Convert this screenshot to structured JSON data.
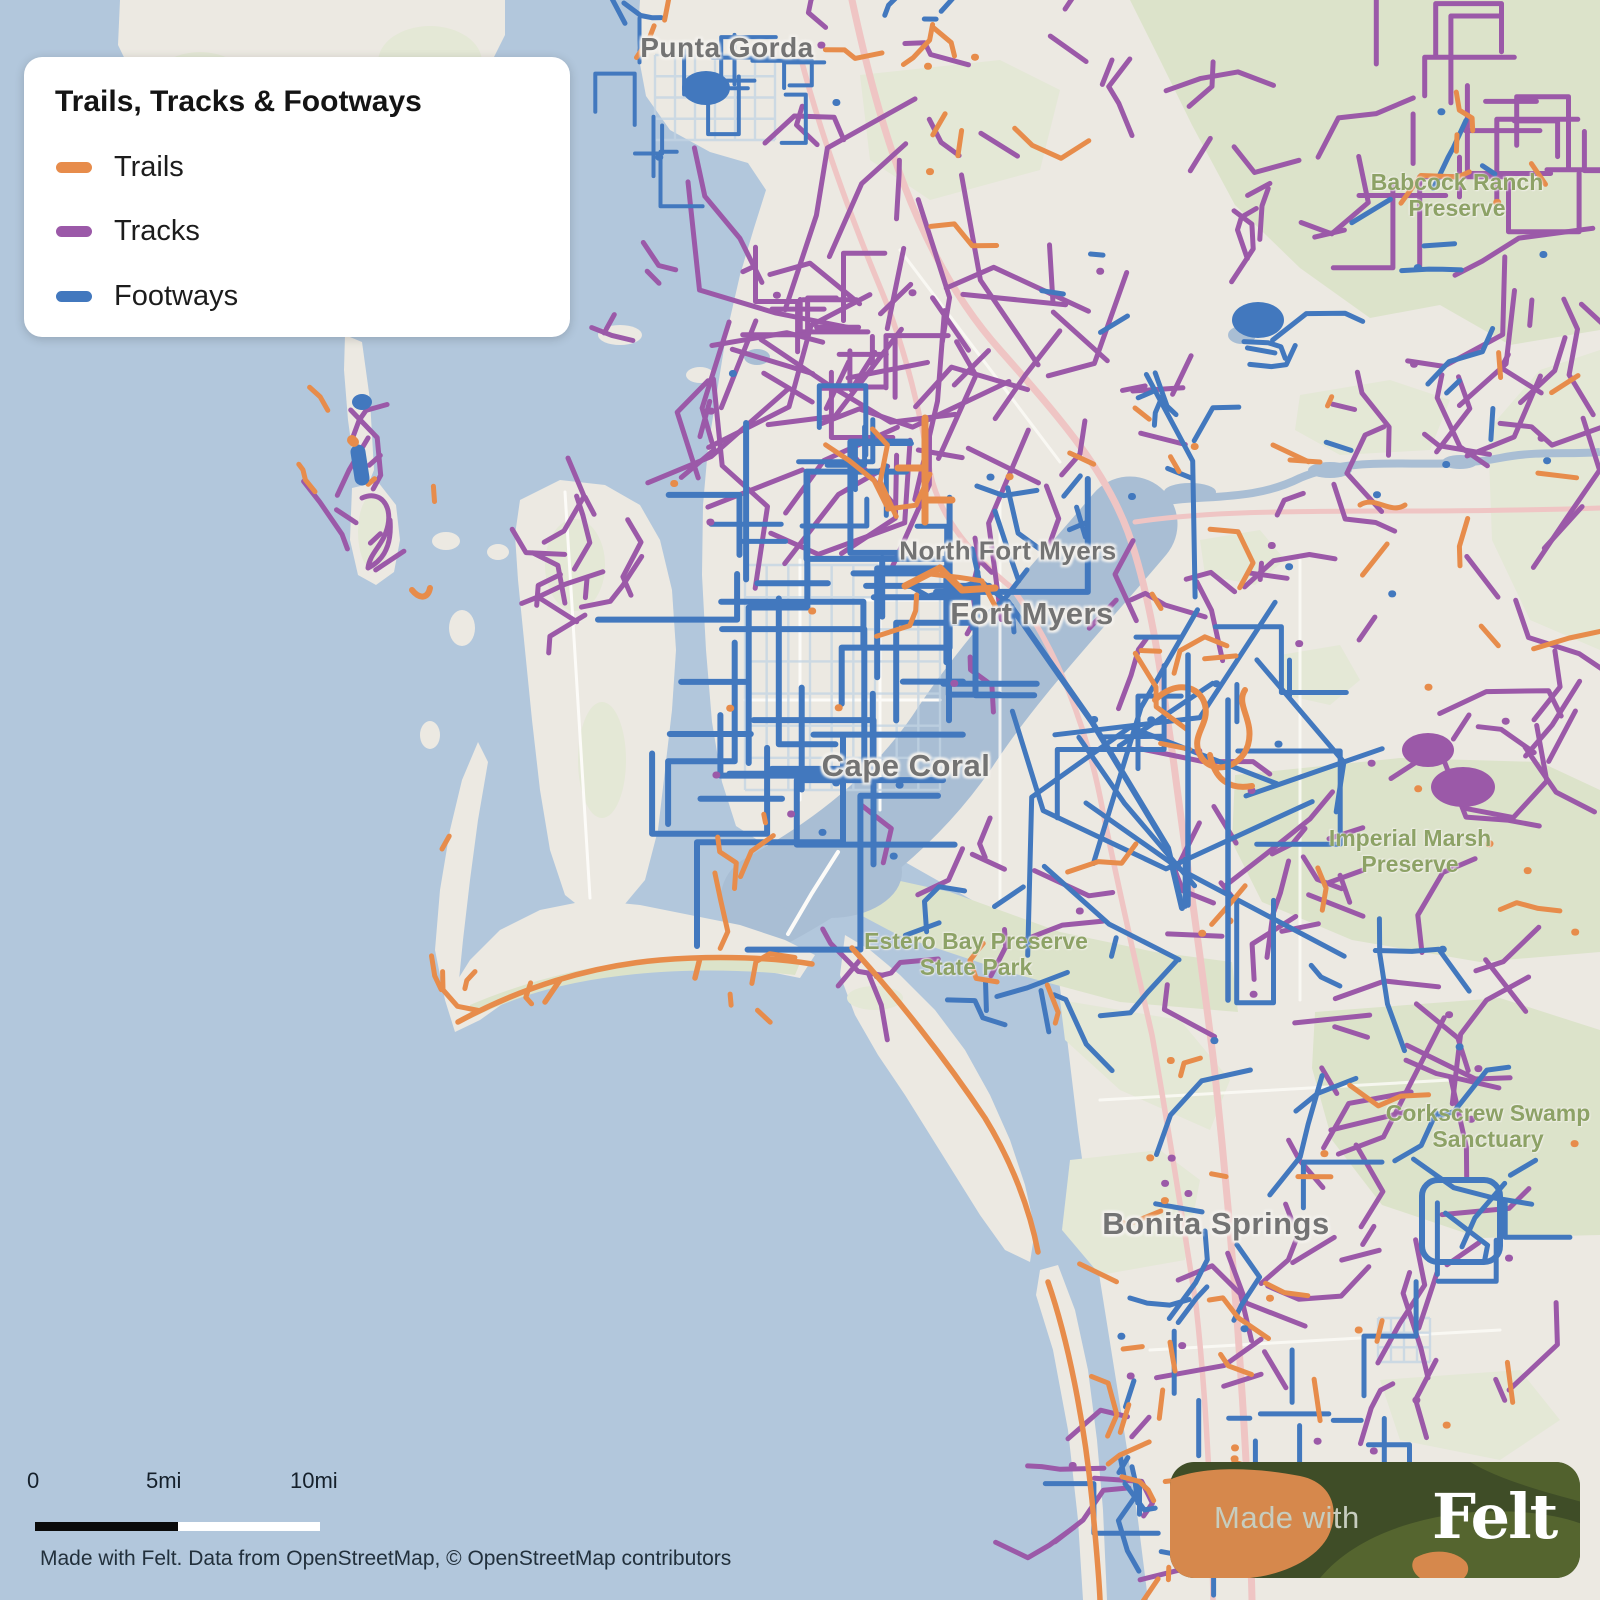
{
  "legend": {
    "title": "Trails, Tracks & Footways",
    "items": [
      {
        "label": "Trails",
        "color": "#E78C4B"
      },
      {
        "label": "Tracks",
        "color": "#9B59A8"
      },
      {
        "label": "Footways",
        "color": "#4278BE"
      }
    ]
  },
  "map": {
    "city_labels": [
      {
        "name": "Punta Gorda"
      },
      {
        "name": "North Fort Myers"
      },
      {
        "name": "Fort Myers"
      },
      {
        "name": "Cape Coral"
      },
      {
        "name": "Bonita Springs"
      }
    ],
    "area_labels": [
      {
        "line1": "Babcock Ranch",
        "line2": "Preserve"
      },
      {
        "line1": "Imperial Marsh",
        "line2": "Preserve"
      },
      {
        "line1": "Estero Bay Preserve",
        "line2": "State Park"
      },
      {
        "line1": "Corkscrew Swamp",
        "line2": "Sanctuary"
      }
    ]
  },
  "scale_bar": {
    "start": "0",
    "mid": "5mi",
    "end": "10mi"
  },
  "attribution": "Made with Felt. Data from OpenStreetMap, © OpenStreetMap contributors",
  "badge": {
    "prefix": "Made with",
    "brand": "Felt"
  },
  "colors": {
    "trails": "#E78C4B",
    "tracks": "#9B59A8",
    "footways": "#4278BE",
    "water": "#B2C7DC",
    "river": "#A9BED4",
    "land": "#ECE9E2",
    "greenspace": "#DCE3CA",
    "greenspace_pale": "#E4E8D6",
    "road_pink": "#EFC5C4",
    "road_white": "#FCFBF8",
    "canal": "#C2D3E3"
  }
}
